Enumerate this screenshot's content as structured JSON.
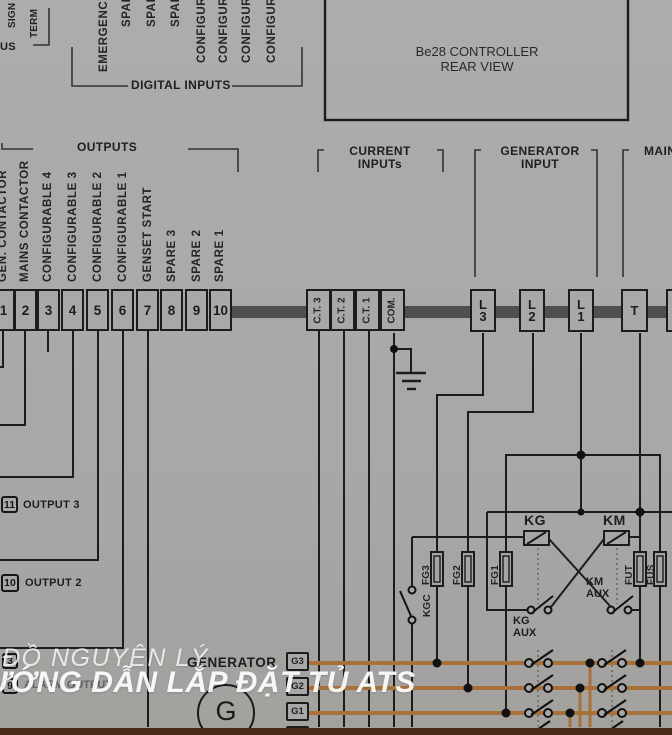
{
  "controller": {
    "title_line1": "Be28 CONTROLLER",
    "title_line2": "REAR VIEW"
  },
  "corner_labels": {
    "signal_fragment": "SIGN",
    "terminal_fragment": "TERM",
    "bus_fragment": "US"
  },
  "digital_inputs": {
    "section_label": "DIGITAL INPUTS",
    "labels": [
      "EMERGENCY",
      "SPARE",
      "SPARE",
      "SPARE",
      "CONFIGURABLE",
      "CONFIGURABLE",
      "CONFIGURABLE",
      "CONFIGURABLE"
    ]
  },
  "outputs": {
    "section_label": "OUTPUTS",
    "labels": [
      "GEN. CONTACTOR",
      "MAINS CONTACTOR",
      "CONFIGURABLE 4",
      "CONFIGURABLE 3",
      "CONFIGURABLE 2",
      "CONFIGURABLE 1",
      "GENSET START",
      "SPARE 3",
      "SPARE 2",
      "SPARE 1"
    ],
    "terminal_numbers": [
      "1",
      "2",
      "3",
      "4",
      "5",
      "6",
      "7",
      "8",
      "9",
      "10"
    ]
  },
  "current_inputs": {
    "label_line1": "CURRENT",
    "label_line2": "INPUTs",
    "terminals": [
      "C.T. 3",
      "C.T. 2",
      "C.T. 1",
      "COM."
    ]
  },
  "generator_input": {
    "label_line1": "GENERATOR",
    "label_line2": "INPUT",
    "terminals": [
      {
        "letter": "L",
        "digit": "3"
      },
      {
        "letter": "L",
        "digit": "2"
      },
      {
        "letter": "L",
        "digit": "1"
      }
    ]
  },
  "mains": {
    "label": "MAINS",
    "terminal": "T"
  },
  "control_circuit": {
    "kg": "KG",
    "km": "KM",
    "kgc": "KGC",
    "kg_aux_line1": "KG",
    "kg_aux_line2": "AUX",
    "km_aux_line1": "KM",
    "km_aux_line2": "AUX",
    "fuses": [
      "FG3",
      "FG2",
      "FG1",
      "FUT",
      "FUS"
    ]
  },
  "output_annotations": {
    "output3_terminal": "11",
    "output3_label": "OUTPUT 3",
    "output2_terminal": "10",
    "output2_label": "OUTPUT 2",
    "lower_terminal_a": "3",
    "lower_terminal_b": "9",
    "obscured_label": "ALARM OUTPUT"
  },
  "generator": {
    "label": "GENERATOR",
    "symbol": "G",
    "terminals": [
      "G3",
      "G2",
      "G1"
    ]
  },
  "watermark": {
    "line1": "ĐỒ NGUYÊN LÝ",
    "line2": "ƯỚNG DẪN LẮP ĐẶT TỦ ATS"
  },
  "colors": {
    "background": "#a8a8a8",
    "line": "#1c1c1c",
    "bus_bar": "#4f4f4f",
    "wire_orange": "#a9713a",
    "bottom_strip": "#4a2b1a",
    "watermark": "#ffffff"
  }
}
